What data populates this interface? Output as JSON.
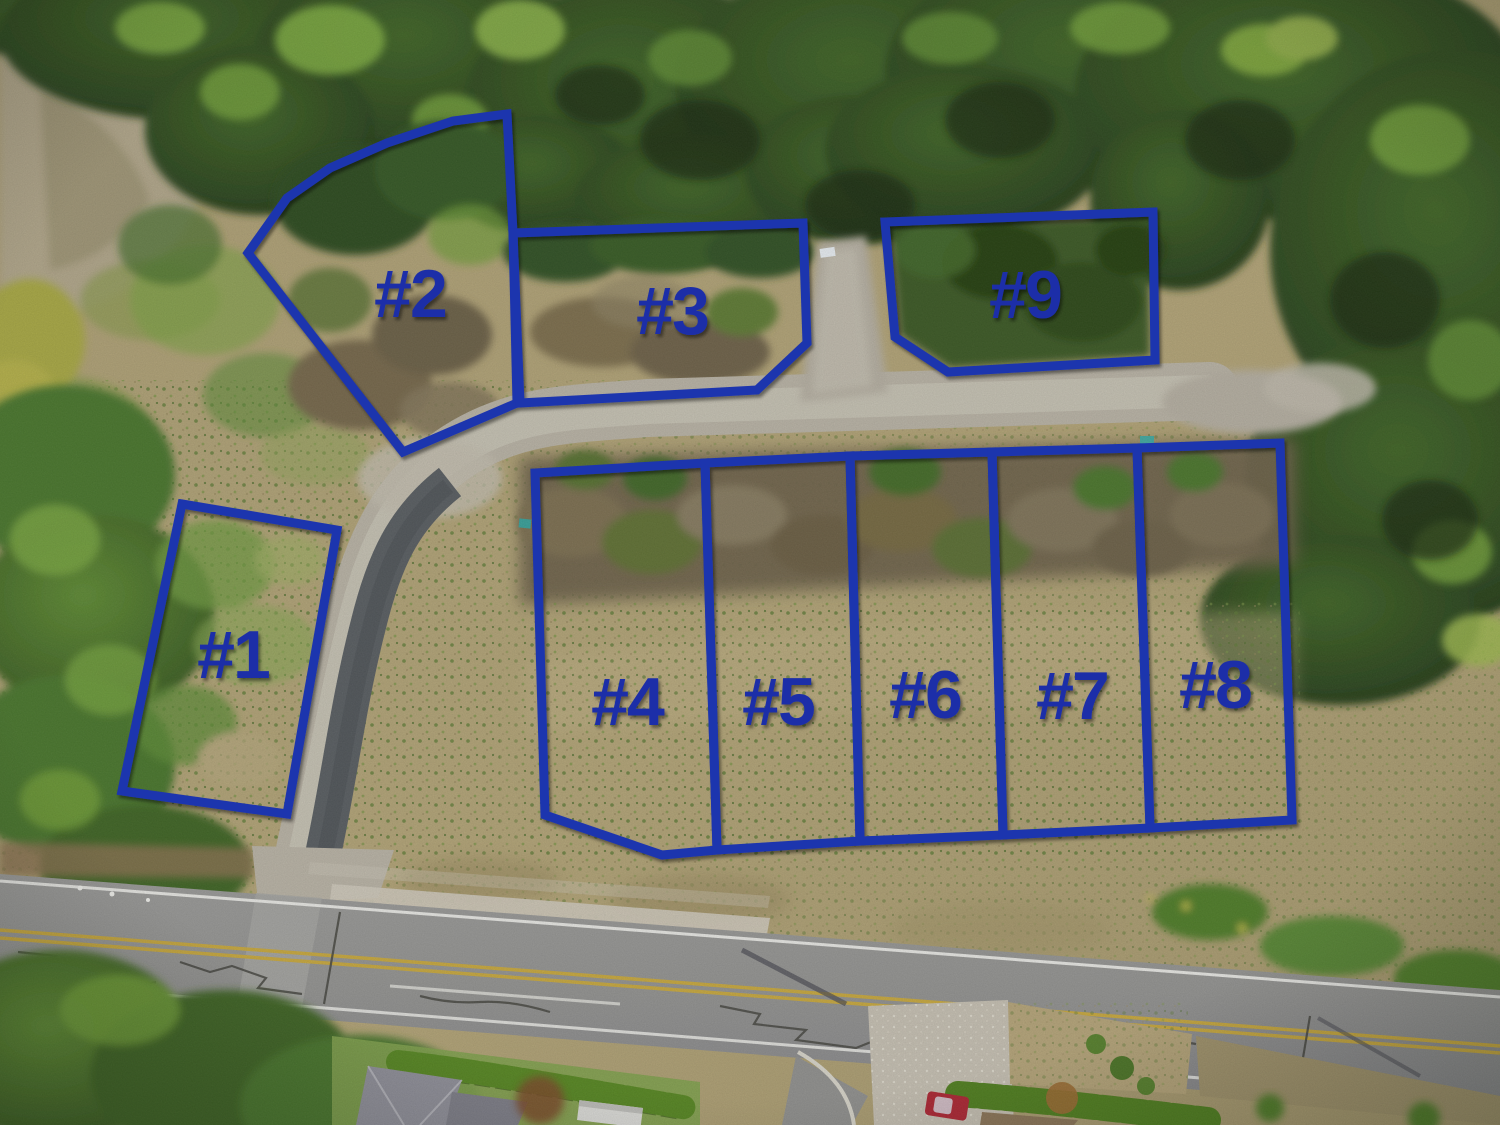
{
  "image_title": "Aerial drone view of subdivision with nine numbered lots outlined",
  "annotation": {
    "stroke_color": "#1e34ae",
    "label_color": "#1c2fa8",
    "stroke_width": 9,
    "lots": [
      {
        "id": "1",
        "label": "#1",
        "points": "182,504 337,530 287,814 122,791",
        "label_x": 233,
        "label_y": 660
      },
      {
        "id": "2",
        "label": "#2",
        "points": "507,114 453,121 387,143 330,168 287,198 248,253 403,452 517,403 513,233",
        "label_x": 410,
        "label_y": 299
      },
      {
        "id": "3",
        "label": "#3",
        "points": "513,233 803,223 807,343 757,390 520,403",
        "label_x": 672,
        "label_y": 316
      },
      {
        "id": "4",
        "label": "#4",
        "points": "535,473 705,463 717,850 662,855 545,815",
        "label_x": 627,
        "label_y": 707
      },
      {
        "id": "5",
        "label": "#5",
        "points": "705,463 850,456 860,841 717,850",
        "label_x": 778,
        "label_y": 707
      },
      {
        "id": "6",
        "label": "#6",
        "points": "850,456 992,452 1003,835 860,841",
        "label_x": 925,
        "label_y": 700
      },
      {
        "id": "7",
        "label": "#7",
        "points": "992,452 1137,448 1150,828 1003,835",
        "label_x": 1072,
        "label_y": 701
      },
      {
        "id": "8",
        "label": "#8",
        "points": "1137,448 1280,443 1292,820 1150,828",
        "label_x": 1215,
        "label_y": 690
      },
      {
        "id": "9",
        "label": "#9",
        "points": "885,222 1153,212 1155,360 948,372 895,337",
        "label_x": 1025,
        "label_y": 300
      }
    ]
  }
}
